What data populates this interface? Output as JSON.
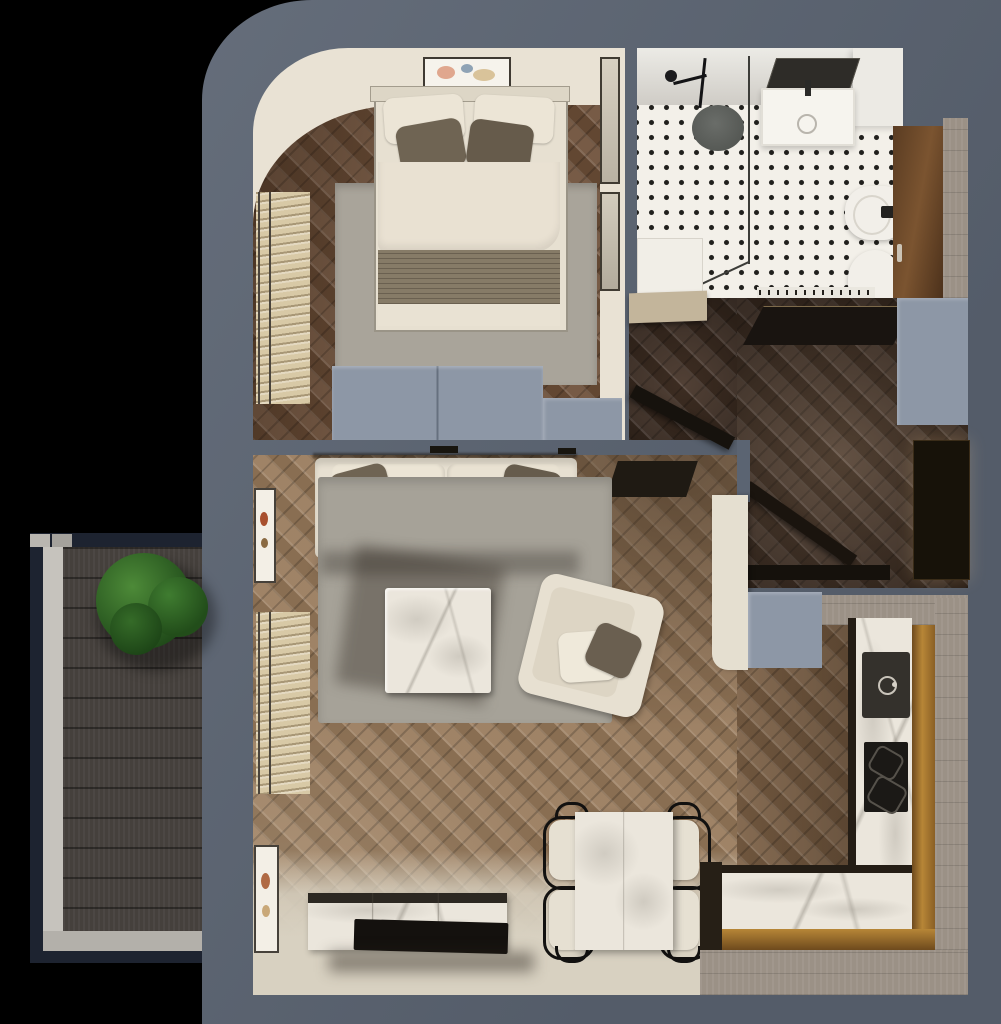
{
  "scene": {
    "kind": "3d-apartment-floor-plan-render",
    "view": "top-down",
    "width_px": 1001,
    "height_px": 1024
  },
  "palette": {
    "wall": "#5b6472",
    "blueGray": "#8d97a6",
    "cream": "#e9e2d4",
    "bedFloor": "#6d4f38",
    "liveFloor": "#987a5b",
    "hallFloor": "#443226",
    "kitchFloor": "#7c6045",
    "lightFloor": "#d8d1c1",
    "planks": "#9b9186",
    "deck": "#45403c",
    "deckFrame": "#1d2330",
    "tile": "#f3f0e9",
    "tileDot": "#21201d",
    "marble": "#ebe6dc",
    "amber1": "#6e4a1d",
    "amber2": "#b78637",
    "rugBed": "#a9a49a",
    "rugLive": "#a6a298",
    "sofaCream": "#e7e0d1",
    "taupe": "#6f6453",
    "darkWood": "#17120c",
    "plantDark": "#1d4517",
    "plantLight": "#4d8a38"
  },
  "rooms": [
    {
      "id": "bedroom",
      "furniture": [
        "double-bed",
        "pillows",
        "blanket",
        "rug",
        "wall-art",
        "wardrobe-mirrors",
        "window-blinds",
        "dresser"
      ]
    },
    {
      "id": "bathroom",
      "furniture": [
        "walk-in-shower",
        "glass-screen",
        "shower-mat",
        "mirror",
        "vanity-sink",
        "bidet",
        "toilet",
        "wood-cabinet"
      ]
    },
    {
      "id": "inner-hall",
      "furniture": [
        "side-cabinet",
        "open-door"
      ]
    },
    {
      "id": "entry-hall",
      "furniture": [
        "coat-rack",
        "console-table",
        "wardrobe",
        "entry-door"
      ]
    },
    {
      "id": "living-room",
      "furniture": [
        "sofa",
        "cushions",
        "rug",
        "coffee-table",
        "armchair",
        "side-console",
        "wall-art",
        "window-blinds",
        "tv-stand",
        "tv"
      ]
    },
    {
      "id": "dining-area",
      "furniture": [
        "marble-table",
        "four-chairs"
      ]
    },
    {
      "id": "kitchen",
      "furniture": [
        "l-shaped-counter",
        "sink",
        "cooktop",
        "partition-wall"
      ]
    },
    {
      "id": "balcony",
      "furniture": [
        "decking",
        "potted-plant"
      ]
    }
  ]
}
